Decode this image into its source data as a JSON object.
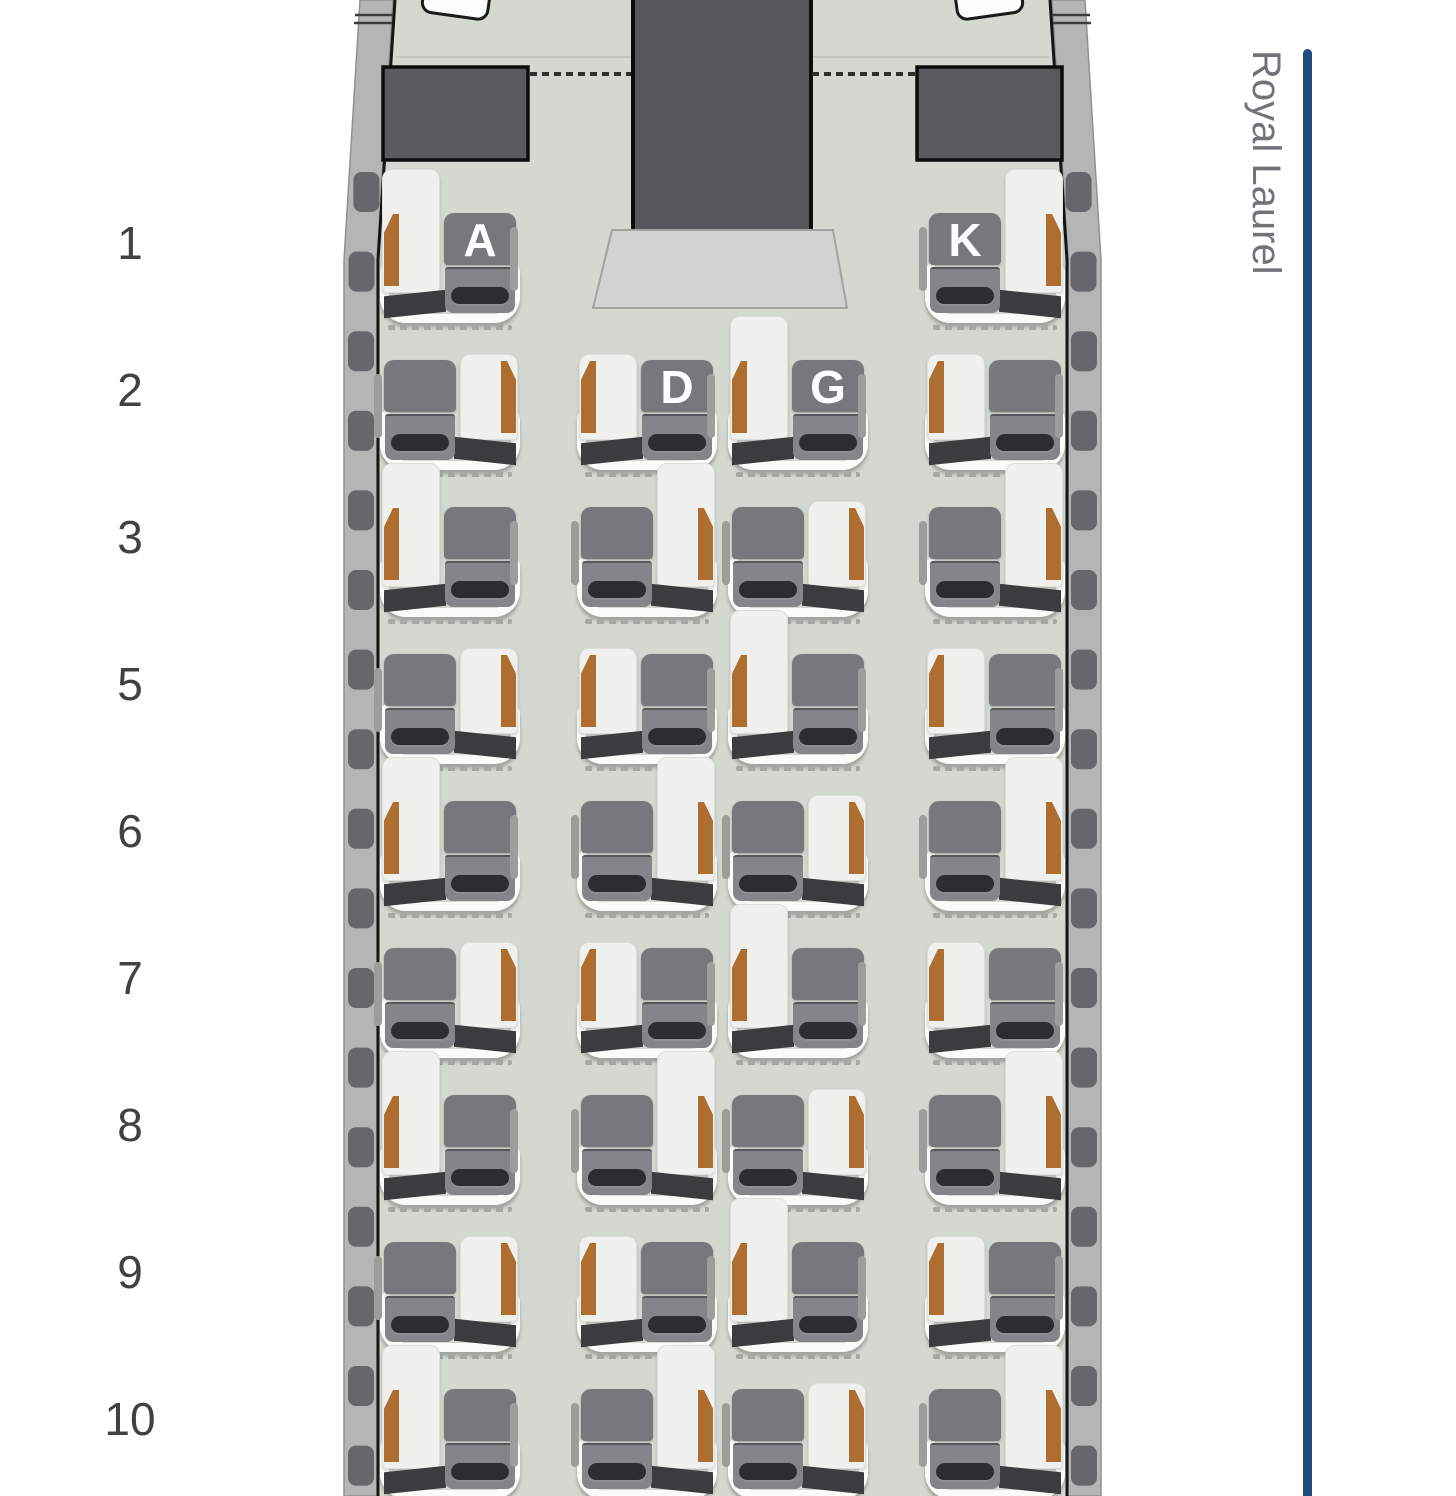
{
  "side_label": {
    "text": "Royal Laurel"
  },
  "cabin": {
    "class_name": "Royal Laurel",
    "seat_columns": [
      "A",
      "D",
      "G",
      "K"
    ],
    "rows": [
      {
        "number": "1",
        "variant": "b",
        "seats": [
          {
            "letter": "A",
            "label_visible": true
          },
          {
            "letter": "K",
            "label_visible": true
          }
        ]
      },
      {
        "number": "2",
        "variant": "a",
        "seats": [
          {
            "letter": "A",
            "label_visible": false
          },
          {
            "letter": "D",
            "label_visible": true
          },
          {
            "letter": "G",
            "label_visible": true
          },
          {
            "letter": "K",
            "label_visible": false
          }
        ]
      },
      {
        "number": "3",
        "variant": "b",
        "seats": [
          {
            "letter": "A",
            "label_visible": false
          },
          {
            "letter": "D",
            "label_visible": false
          },
          {
            "letter": "G",
            "label_visible": false
          },
          {
            "letter": "K",
            "label_visible": false
          }
        ]
      },
      {
        "number": "5",
        "variant": "a",
        "seats": [
          {
            "letter": "A",
            "label_visible": false
          },
          {
            "letter": "D",
            "label_visible": false
          },
          {
            "letter": "G",
            "label_visible": false
          },
          {
            "letter": "K",
            "label_visible": false
          }
        ]
      },
      {
        "number": "6",
        "variant": "b",
        "seats": [
          {
            "letter": "A",
            "label_visible": false
          },
          {
            "letter": "D",
            "label_visible": false
          },
          {
            "letter": "G",
            "label_visible": false
          },
          {
            "letter": "K",
            "label_visible": false
          }
        ]
      },
      {
        "number": "7",
        "variant": "a",
        "seats": [
          {
            "letter": "A",
            "label_visible": false
          },
          {
            "letter": "D",
            "label_visible": false
          },
          {
            "letter": "G",
            "label_visible": false
          },
          {
            "letter": "K",
            "label_visible": false
          }
        ]
      },
      {
        "number": "8",
        "variant": "b",
        "seats": [
          {
            "letter": "A",
            "label_visible": false
          },
          {
            "letter": "D",
            "label_visible": false
          },
          {
            "letter": "G",
            "label_visible": false
          },
          {
            "letter": "K",
            "label_visible": false
          }
        ]
      },
      {
        "number": "9",
        "variant": "a",
        "seats": [
          {
            "letter": "A",
            "label_visible": false
          },
          {
            "letter": "D",
            "label_visible": false
          },
          {
            "letter": "G",
            "label_visible": false
          },
          {
            "letter": "K",
            "label_visible": false
          }
        ]
      },
      {
        "number": "10",
        "variant": "b",
        "seats": [
          {
            "letter": "A",
            "label_visible": false
          },
          {
            "letter": "D",
            "label_visible": false
          },
          {
            "letter": "G",
            "label_visible": false
          },
          {
            "letter": "K",
            "label_visible": false
          }
        ]
      }
    ]
  },
  "colors": {
    "accent_rail": "#1F4C7E",
    "side_label_text": "#717379",
    "row_number_text": "#3F4142",
    "floor": "#D3D9D0",
    "wall_band": "#B3B6B4",
    "monument": "#56575A",
    "seat_gray": "#76787B",
    "seat_letter": "#FFFFFF",
    "ottoman_accent_orange": "#AD6E2F"
  }
}
